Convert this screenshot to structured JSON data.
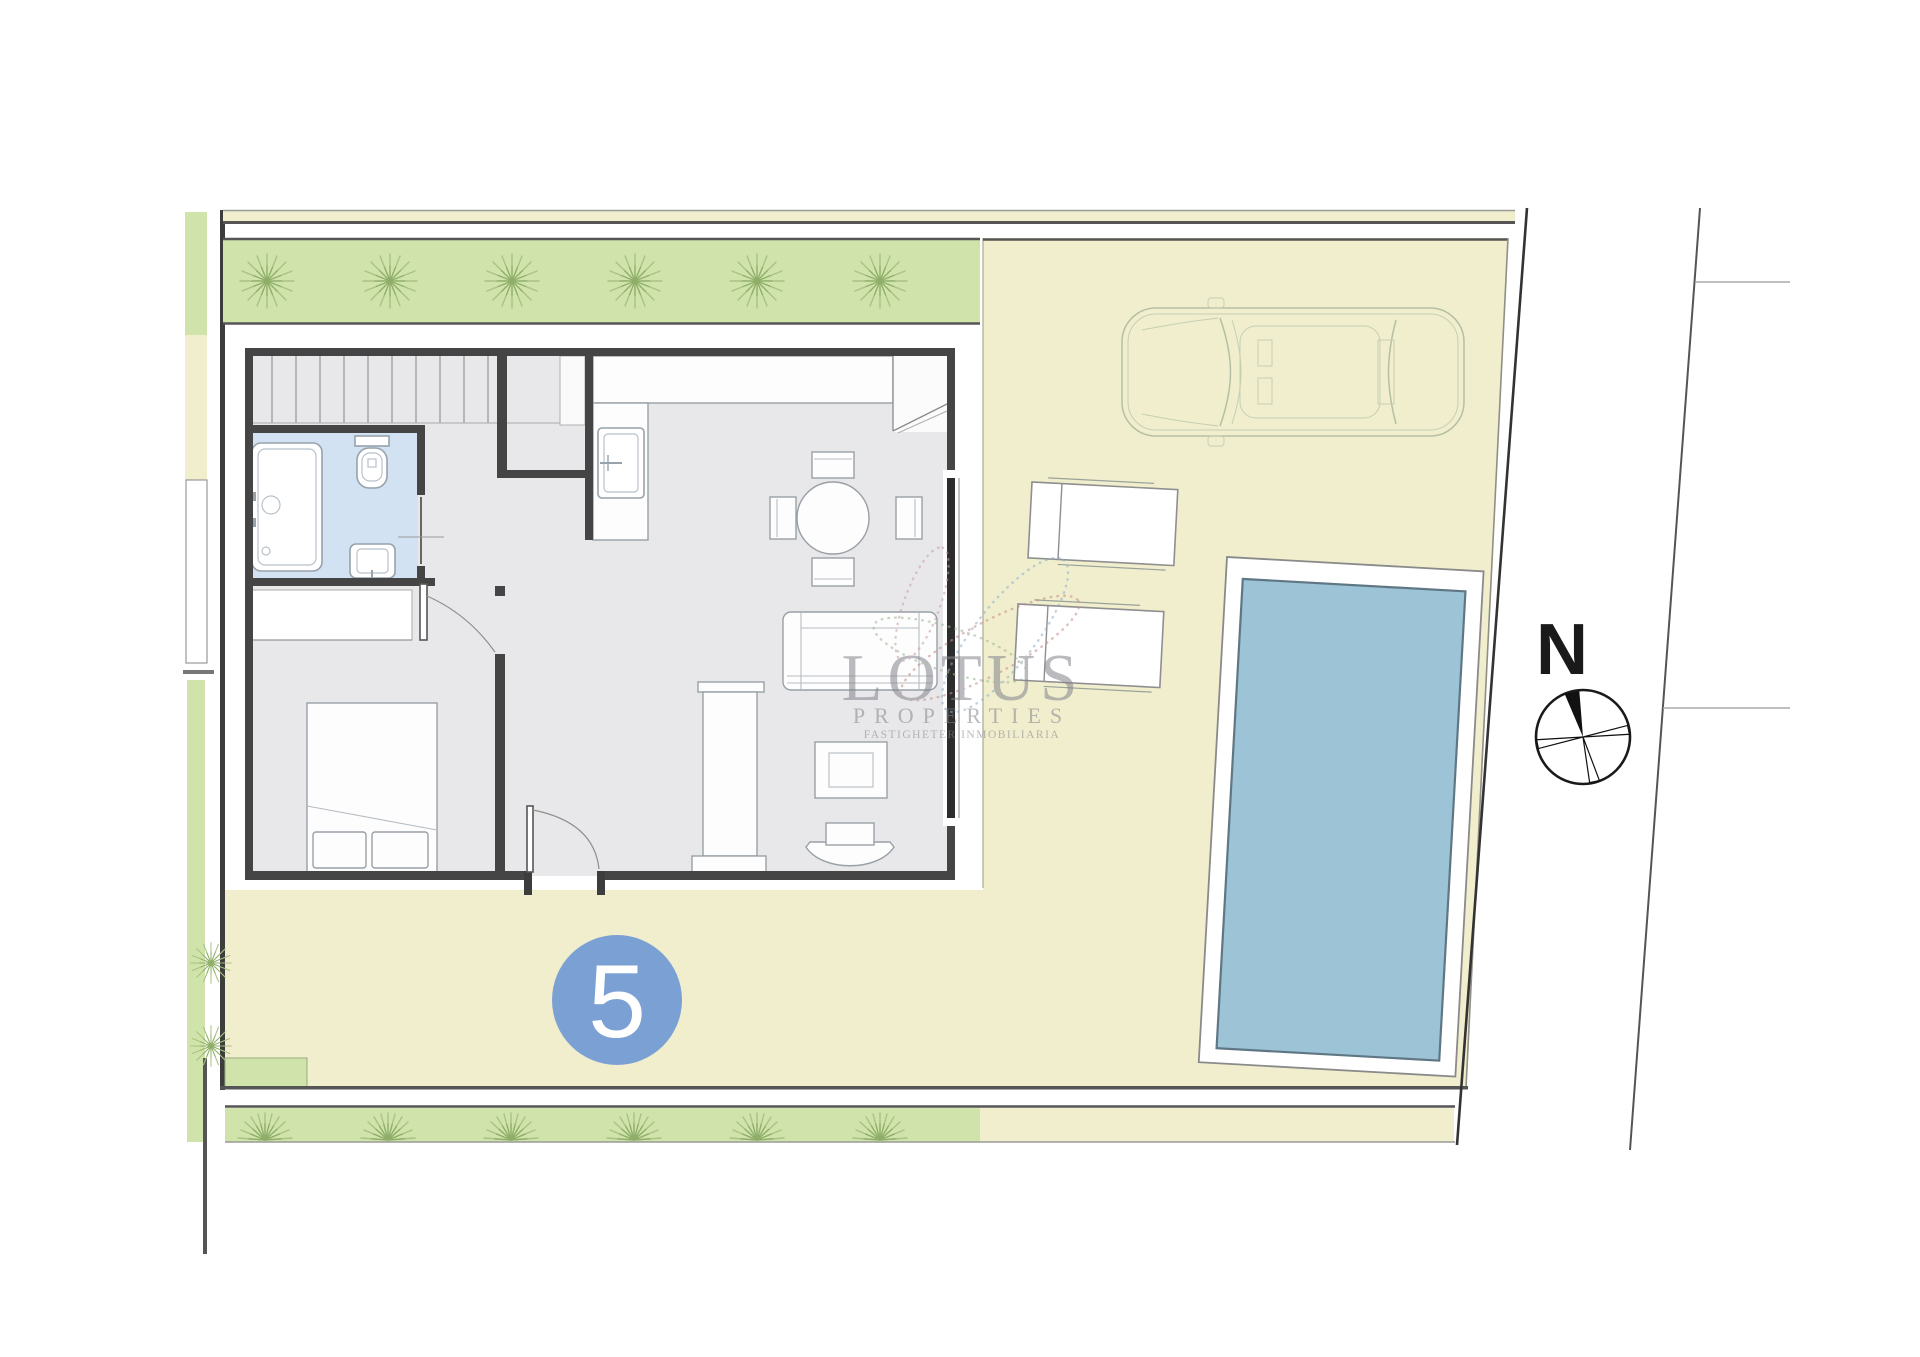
{
  "watermark": {
    "brand": "LOTUS",
    "subtitle": "PROPERTIES",
    "tagline": "FASTIGHETER INMOBILIARIA"
  },
  "plot": {
    "number": "5"
  },
  "compass": {
    "north_label": "N"
  },
  "colors": {
    "plot_yellow": "#f0eecd",
    "grass_green": "#cfe3ab",
    "pool_water": "#9dc4d6",
    "bathroom_floor": "#d2e2f2",
    "badge_blue": "#7ba1d4",
    "glass_dark": "#2d2d2d"
  }
}
